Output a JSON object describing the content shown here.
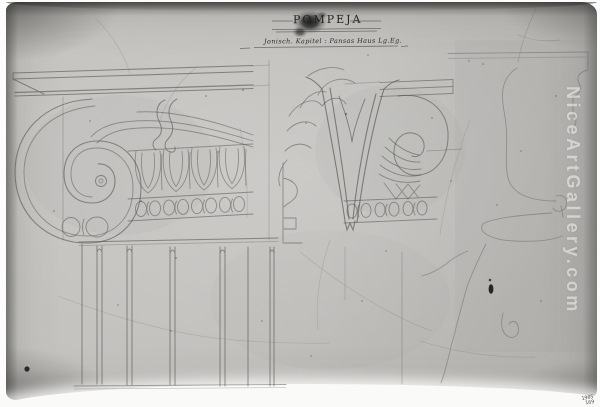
{
  "artwork": {
    "title": "POMPEJA",
    "subtitle": "Jonisch. Kapitel : Pansas Haus Lg.Eg."
  },
  "watermark": {
    "text": "NiceArtGallery.com"
  },
  "catalog_number": {
    "line1": "1905",
    "line2": "169"
  },
  "colors": {
    "background": "#ffffff",
    "paper": "#c2c1be",
    "photo_edge": "#8f8e8c",
    "pencil": "#55534f",
    "watermark": "#ffffff"
  }
}
